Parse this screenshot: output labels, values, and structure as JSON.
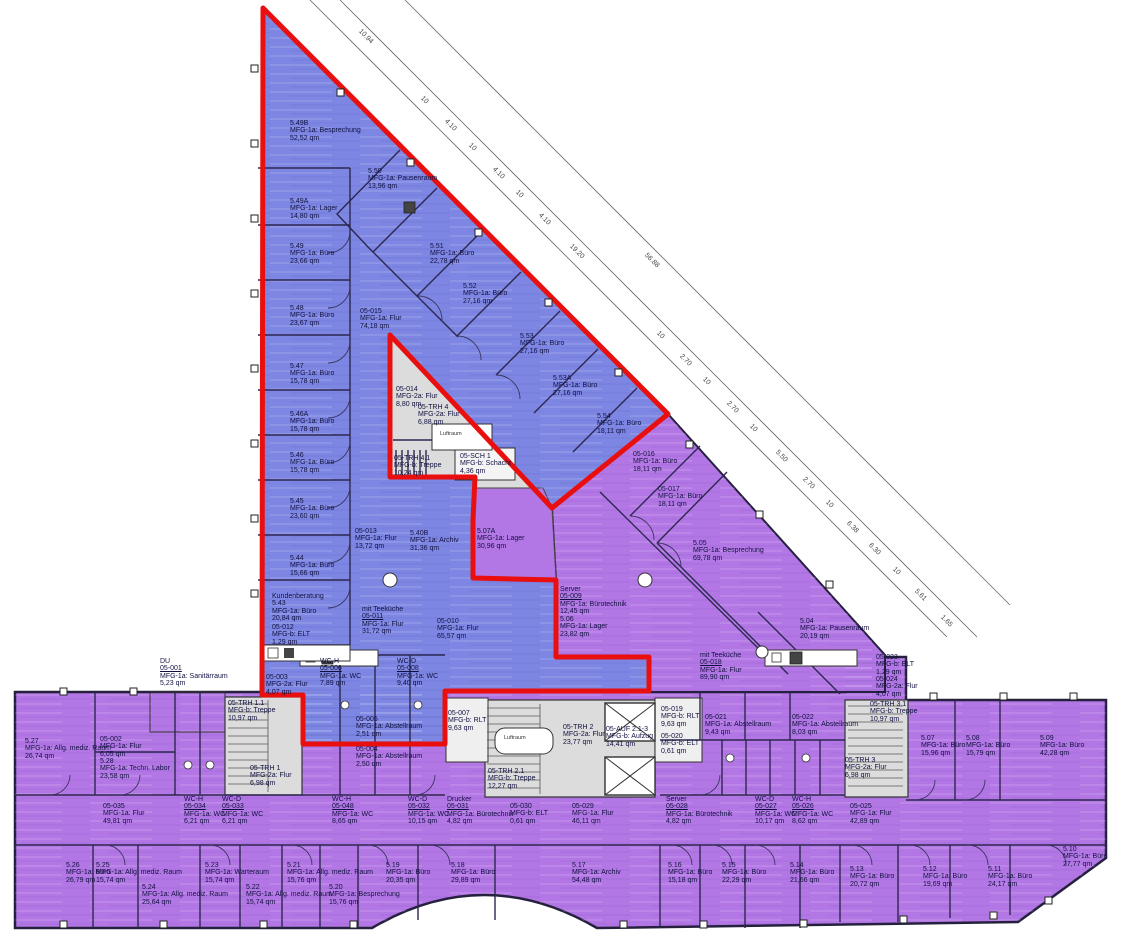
{
  "colors": {
    "zone_blue": "#7d87e3",
    "zone_purple": "#b377e5",
    "highlight_red": "#e90f0f",
    "core_gray": "#dcdcdc",
    "wall": "#2c2750",
    "text": "#101040"
  },
  "core_labels": [
    {
      "text": "Luftraum",
      "x": 440,
      "y": 431
    },
    {
      "text": "Luftraum",
      "x": 504,
      "y": 735
    }
  ],
  "rooms": [
    {
      "lines": [
        "5.49B",
        "MFG-1a: Besprechung",
        "52,52 qm"
      ],
      "x": 290,
      "y": 120
    },
    {
      "lines": [
        "5.50",
        "MFG-1a: Pausenraum",
        "13,96 qm"
      ],
      "x": 368,
      "y": 168
    },
    {
      "lines": [
        "5.49A",
        "MFG-1a: Lager",
        "14,80 qm"
      ],
      "x": 290,
      "y": 198
    },
    {
      "lines": [
        "5.49",
        "MFG-1a: Büro",
        "23,66 qm"
      ],
      "x": 290,
      "y": 243
    },
    {
      "lines": [
        "5.48",
        "MFG-1a: Büro",
        "23,67 qm"
      ],
      "x": 290,
      "y": 305
    },
    {
      "lines": [
        "05-015",
        "MFG-1a: Flur",
        "74,18 qm"
      ],
      "x": 360,
      "y": 308
    },
    {
      "lines": [
        "5.51",
        "MFG-1a: Büro",
        "22,78 qm"
      ],
      "x": 430,
      "y": 243
    },
    {
      "lines": [
        "5.52",
        "MFG-1a: Büro",
        "27,16 qm"
      ],
      "x": 463,
      "y": 283
    },
    {
      "lines": [
        "5.53",
        "MFG-1a: Büro",
        "27,16 qm"
      ],
      "x": 520,
      "y": 333
    },
    {
      "lines": [
        "5.53A",
        "MFG-1a: Büro",
        "27,16 qm"
      ],
      "x": 553,
      "y": 375
    },
    {
      "lines": [
        "5.54",
        "MFG-1a: Büro",
        "18,11 qm"
      ],
      "x": 597,
      "y": 413
    },
    {
      "lines": [
        "05-016",
        "MFG-1a: Büro",
        "18,11 qm"
      ],
      "x": 633,
      "y": 451
    },
    {
      "lines": [
        "05-017",
        "MFG-1a: Büro",
        "18,11 qm"
      ],
      "x": 658,
      "y": 486
    },
    {
      "lines": [
        "5.05",
        "MFG-1a: Besprechung",
        "69,78 qm"
      ],
      "x": 693,
      "y": 540
    },
    {
      "lines": [
        "05-014",
        "MFG-2a: Flur",
        "8,80 qm"
      ],
      "x": 396,
      "y": 386
    },
    {
      "lines": [
        "05-TRH 4",
        "MFG-2a: Flur",
        "6,88 qm"
      ],
      "x": 418,
      "y": 404
    },
    {
      "lines": [
        "05-TRH 4.1",
        "MFG-b: Treppe",
        "10,24 qm"
      ],
      "x": 394,
      "y": 455
    },
    {
      "lines": [
        "05-SCH 1",
        "MFG-b: Schacht",
        "4,36 qm"
      ],
      "x": 460,
      "y": 453
    },
    {
      "lines": [
        "05-013",
        "MFG-1a: Flur",
        "13,72 qm"
      ],
      "x": 355,
      "y": 528
    },
    {
      "lines": [
        "5.40B",
        "MFG-1a: Archiv",
        "31,36 qm"
      ],
      "x": 410,
      "y": 530
    },
    {
      "lines": [
        "5.07A",
        "MFG-1a: Lager",
        "30,96 qm"
      ],
      "x": 477,
      "y": 528
    },
    {
      "lines": [
        "5.47",
        "MFG-1a: Büro",
        "15,78 qm"
      ],
      "x": 290,
      "y": 363
    },
    {
      "lines": [
        "5.46A",
        "MFG-1a: Büro",
        "15,78 qm"
      ],
      "x": 290,
      "y": 411
    },
    {
      "lines": [
        "5.46",
        "MFG-1a: Büro",
        "15,78 qm"
      ],
      "x": 290,
      "y": 452
    },
    {
      "lines": [
        "5.45",
        "MFG-1a: Büro",
        "23,60 qm"
      ],
      "x": 290,
      "y": 498
    },
    {
      "lines": [
        "5.44",
        "MFG-1a: Büro",
        "15,66 qm"
      ],
      "x": 290,
      "y": 555
    },
    {
      "lines": [
        "Kundenberatung",
        "5.43",
        "MFG-1a: Büro",
        "20,84 qm"
      ],
      "x": 272,
      "y": 593
    },
    {
      "lines": [
        "05-012",
        "MFG-b: ELT",
        "1,29 qm"
      ],
      "x": 272,
      "y": 624
    },
    {
      "lines": [
        "mit Teeküche",
        "05-011",
        "MFG-1a: Flur",
        "31,72 qm"
      ],
      "x": 362,
      "y": 606
    },
    {
      "lines": [
        "05-010",
        "MFG-1a: Flur",
        "65,57 qm"
      ],
      "x": 437,
      "y": 618
    },
    {
      "lines": [
        "Server",
        "05-009",
        "MFG-1a: Bürotechnik",
        "12,45 qm"
      ],
      "x": 560,
      "y": 586
    },
    {
      "lines": [
        "5.06",
        "MFG-1a: Lager",
        "23,82 qm"
      ],
      "x": 560,
      "y": 616
    },
    {
      "lines": [
        "WC-H",
        "05-006",
        "MFG-1a: WC",
        "7,89 qm"
      ],
      "x": 320,
      "y": 658
    },
    {
      "lines": [
        "WC-D",
        "05-008",
        "MFG-1a: WC",
        "9,40 qm"
      ],
      "x": 397,
      "y": 658
    },
    {
      "lines": [
        "05-005",
        "MFG-1a: Abstellraum",
        "2,51 qm"
      ],
      "x": 356,
      "y": 716
    },
    {
      "lines": [
        "05-004",
        "MFG-1a: Abstellraum",
        "2,50 qm"
      ],
      "x": 356,
      "y": 746
    },
    {
      "lines": [
        "DU",
        "05-001",
        "MFG-1a: Sanitärraum",
        "5,23 qm"
      ],
      "x": 160,
      "y": 658
    },
    {
      "lines": [
        "5.27",
        "MFG-1a: Allg. mediz. Raum",
        "26,74 qm"
      ],
      "x": 25,
      "y": 738
    },
    {
      "lines": [
        "05-002",
        "MFG-1a: Flur",
        "6,05 qm"
      ],
      "x": 100,
      "y": 736
    },
    {
      "lines": [
        "5.28",
        "MFG-1a: Techn. Labor",
        "23,58 qm"
      ],
      "x": 100,
      "y": 758
    },
    {
      "lines": [
        "05-TRH 1.1",
        "MFG-b: Treppe",
        "10,97 qm"
      ],
      "x": 228,
      "y": 700
    },
    {
      "lines": [
        "05-TRH 1",
        "MFG-2a: Flur",
        "6,98 qm"
      ],
      "x": 250,
      "y": 765
    },
    {
      "lines": [
        "05-003",
        "MFG-2a: Flur",
        "4,07 qm"
      ],
      "x": 266,
      "y": 674
    },
    {
      "lines": [
        "05-007",
        "MFG-b: RLT",
        "9,63 qm"
      ],
      "x": 448,
      "y": 710
    },
    {
      "lines": [
        "05-TRH 2",
        "MFG-2a: Flur",
        "23,77 qm"
      ],
      "x": 563,
      "y": 724
    },
    {
      "lines": [
        "05-AUF 2.1-3",
        "MFG-b: Aufzug",
        "14,41 qm"
      ],
      "x": 606,
      "y": 726
    },
    {
      "lines": [
        "05-TRH 2.1",
        "MFG-b: Treppe",
        "12,27 qm"
      ],
      "x": 488,
      "y": 768
    },
    {
      "lines": [
        "05-019",
        "MFG-b: RLT",
        "9,63 qm"
      ],
      "x": 661,
      "y": 706
    },
    {
      "lines": [
        "05-020",
        "MFG-b: ELT",
        "0,61 qm"
      ],
      "x": 661,
      "y": 733
    },
    {
      "lines": [
        "05-021",
        "MFG-1a: Abstellraum",
        "9,43 qm"
      ],
      "x": 705,
      "y": 714
    },
    {
      "lines": [
        "05-022",
        "MFG-1a: Abstellraum",
        "8,03 qm"
      ],
      "x": 792,
      "y": 714
    },
    {
      "lines": [
        "05-TRH 3.1",
        "MFG-b: Treppe",
        "10,97 qm"
      ],
      "x": 870,
      "y": 701
    },
    {
      "lines": [
        "05-TRH 3",
        "MFG-2a: Flur",
        "6,98 qm"
      ],
      "x": 845,
      "y": 757
    },
    {
      "lines": [
        "05-023",
        "MFG-b: ELT",
        "1,29 qm"
      ],
      "x": 876,
      "y": 654
    },
    {
      "lines": [
        "05-024",
        "MFG-2a: Flur",
        "4,07 qm"
      ],
      "x": 876,
      "y": 676
    },
    {
      "lines": [
        "5.07",
        "MFG-1a: Büro",
        "15,96 qm"
      ],
      "x": 921,
      "y": 735
    },
    {
      "lines": [
        "5.08",
        "MFG-1a: Büro",
        "15,79 qm"
      ],
      "x": 966,
      "y": 735
    },
    {
      "lines": [
        "5.09",
        "MFG-1a: Büro",
        "42,28 qm"
      ],
      "x": 1040,
      "y": 735
    },
    {
      "lines": [
        "5.04",
        "MFG-1a: Pausenraum",
        "20,19 qm"
      ],
      "x": 800,
      "y": 618
    },
    {
      "lines": [
        "mit Teeküche",
        "05-018",
        "MFG-1a: Flur",
        "89,90 qm"
      ],
      "x": 700,
      "y": 652
    },
    {
      "lines": [
        "05-035",
        "MFG-1a: Flur",
        "49,81 qm"
      ],
      "x": 103,
      "y": 803
    },
    {
      "lines": [
        "WC-H",
        "05-034",
        "MFG-1a: WC",
        "6,21 qm"
      ],
      "x": 184,
      "y": 796
    },
    {
      "lines": [
        "WC-D",
        "05-033",
        "MFG-1a: WC",
        "6,21 qm"
      ],
      "x": 222,
      "y": 796
    },
    {
      "lines": [
        "WC-H",
        "05-048",
        "MFG-1a: WC",
        "8,65 qm"
      ],
      "x": 332,
      "y": 796
    },
    {
      "lines": [
        "WC-D",
        "05-032",
        "MFG-1a: WC",
        "10,15 qm"
      ],
      "x": 408,
      "y": 796
    },
    {
      "lines": [
        "Drucker",
        "05-031",
        "MFG-1a: Bürotechnik",
        "4,82 qm"
      ],
      "x": 447,
      "y": 796
    },
    {
      "lines": [
        "05-030",
        "MFG-b: ELT",
        "0,61 qm"
      ],
      "x": 510,
      "y": 803
    },
    {
      "lines": [
        "05-029",
        "MFG-1a: Flur",
        "46,11 qm"
      ],
      "x": 572,
      "y": 803
    },
    {
      "lines": [
        "Server",
        "05-028",
        "MFG-1a: Bürotechnik",
        "4,82 qm"
      ],
      "x": 666,
      "y": 796
    },
    {
      "lines": [
        "WC-D",
        "05-027",
        "MFG-1a: WC",
        "10,17 qm"
      ],
      "x": 755,
      "y": 796
    },
    {
      "lines": [
        "WC-H",
        "05-026",
        "MFG-1a: WC",
        "8,62 qm"
      ],
      "x": 792,
      "y": 796
    },
    {
      "lines": [
        "05-025",
        "MFG-1a: Flur",
        "42,89 qm"
      ],
      "x": 850,
      "y": 803
    },
    {
      "lines": [
        "5.26",
        "MFG-1a: Büro",
        "26,79 qm"
      ],
      "x": 66,
      "y": 862
    },
    {
      "lines": [
        "5.25",
        "MFG-1a: Allg. mediz. Raum",
        "15,74 qm"
      ],
      "x": 96,
      "y": 862
    },
    {
      "lines": [
        "5.24",
        "MFG-1a: Allg. mediz. Raum",
        "25,64 qm"
      ],
      "x": 142,
      "y": 884
    },
    {
      "lines": [
        "5.23",
        "MFG-1a: Warteraum",
        "15,74 qm"
      ],
      "x": 205,
      "y": 862
    },
    {
      "lines": [
        "5.22",
        "MFG-1a: Allg. mediz. Raum",
        "15,74 qm"
      ],
      "x": 246,
      "y": 884
    },
    {
      "lines": [
        "5.21",
        "MFG-1a: Allg. mediz. Raum",
        "15,76 qm"
      ],
      "x": 287,
      "y": 862
    },
    {
      "lines": [
        "5.20",
        "MFG-1a: Besprechung",
        "15,76 qm"
      ],
      "x": 329,
      "y": 884
    },
    {
      "lines": [
        "5.19",
        "MFG-1a: Büro",
        "20,35 qm"
      ],
      "x": 386,
      "y": 862
    },
    {
      "lines": [
        "5.18",
        "MFG-1a: Büro",
        "29,89 qm"
      ],
      "x": 451,
      "y": 862
    },
    {
      "lines": [
        "5.17",
        "MFG-1a: Archiv",
        "54,48 qm"
      ],
      "x": 572,
      "y": 862
    },
    {
      "lines": [
        "5.16",
        "MFG-1a: Büro",
        "15,18 qm"
      ],
      "x": 668,
      "y": 862
    },
    {
      "lines": [
        "5.15",
        "MFG-1a: Büro",
        "22,29 qm"
      ],
      "x": 722,
      "y": 862
    },
    {
      "lines": [
        "5.14",
        "MFG-1a: Büro",
        "21,66 qm"
      ],
      "x": 790,
      "y": 862
    },
    {
      "lines": [
        "5.13",
        "MFG-1a: Büro",
        "20,72 qm"
      ],
      "x": 850,
      "y": 866
    },
    {
      "lines": [
        "5.12",
        "MFG-1a: Büro",
        "19,69 qm"
      ],
      "x": 923,
      "y": 866
    },
    {
      "lines": [
        "5.11",
        "MFG-1a: Büro",
        "24,17 qm"
      ],
      "x": 988,
      "y": 866
    },
    {
      "lines": [
        "5.10",
        "MFG-1a: Büro",
        "27,77 qm"
      ],
      "x": 1063,
      "y": 846
    }
  ],
  "dimensions": [
    {
      "text": "10.94",
      "x": 362,
      "y": 28
    },
    {
      "text": "10",
      "x": 424,
      "y": 95
    },
    {
      "text": "4.10",
      "x": 448,
      "y": 118
    },
    {
      "text": "10",
      "x": 472,
      "y": 142
    },
    {
      "text": "4.10",
      "x": 496,
      "y": 166
    },
    {
      "text": "10",
      "x": 519,
      "y": 189
    },
    {
      "text": "4.10",
      "x": 542,
      "y": 212
    },
    {
      "text": "19.20",
      "x": 573,
      "y": 243
    },
    {
      "text": "56.88",
      "x": 648,
      "y": 252
    },
    {
      "text": "10",
      "x": 660,
      "y": 330
    },
    {
      "text": "2.70",
      "x": 683,
      "y": 353
    },
    {
      "text": "10",
      "x": 706,
      "y": 376
    },
    {
      "text": "2.70",
      "x": 730,
      "y": 400
    },
    {
      "text": "10",
      "x": 753,
      "y": 423
    },
    {
      "text": "5.50",
      "x": 779,
      "y": 449
    },
    {
      "text": "2.70",
      "x": 806,
      "y": 476
    },
    {
      "text": "10",
      "x": 829,
      "y": 499
    },
    {
      "text": "6.38",
      "x": 850,
      "y": 520
    },
    {
      "text": "6.30",
      "x": 872,
      "y": 542
    },
    {
      "text": "10",
      "x": 896,
      "y": 566
    },
    {
      "text": "5.61",
      "x": 918,
      "y": 588
    },
    {
      "text": "1.65",
      "x": 944,
      "y": 614
    }
  ]
}
